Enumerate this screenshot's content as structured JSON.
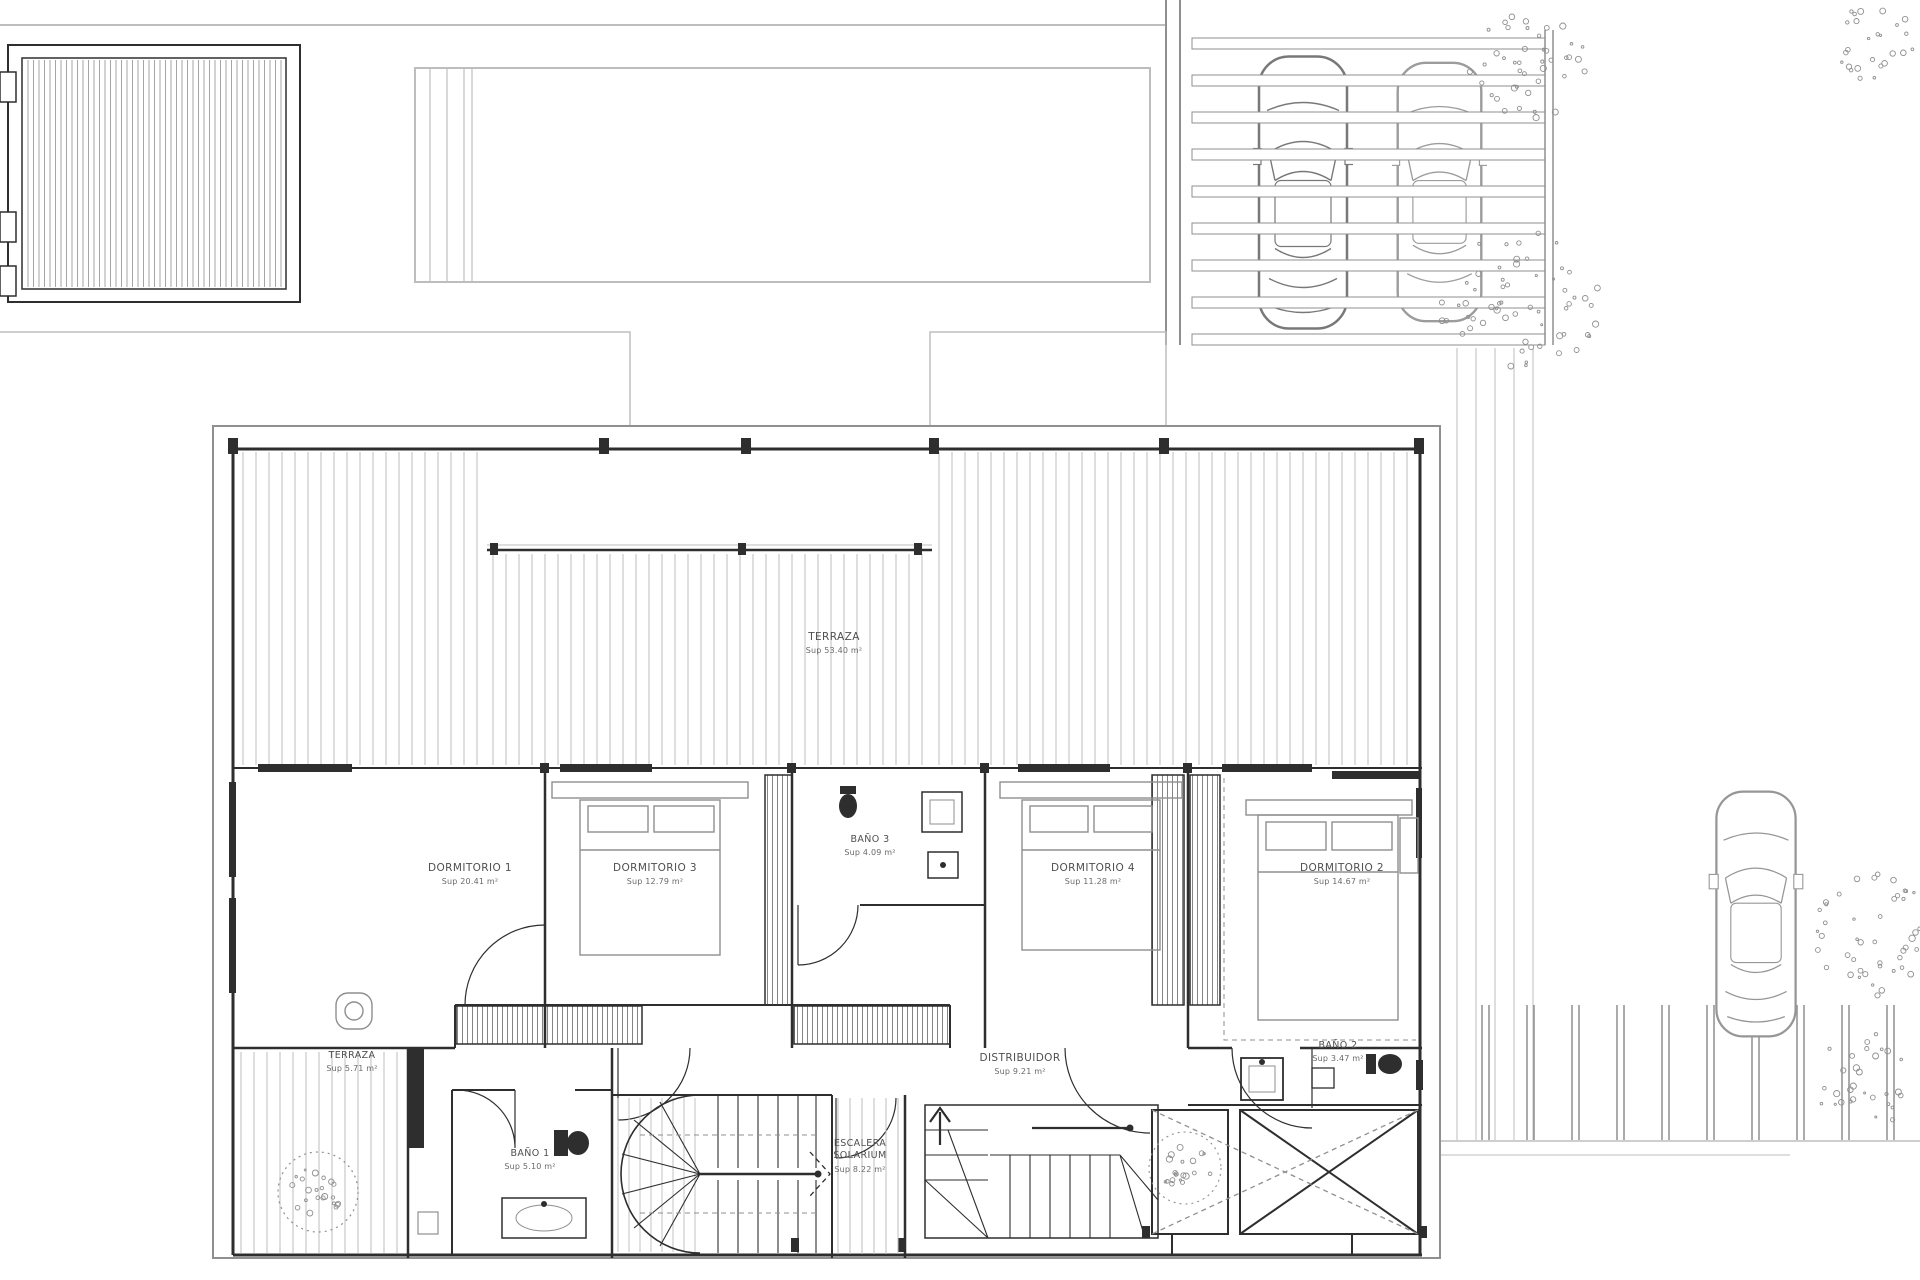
{
  "rooms": {
    "terraza_upper": {
      "name": "TERRAZA",
      "area": "Sup 53.40 m²"
    },
    "dormitorio1": {
      "name": "DORMITORIO 1",
      "area": "Sup 20.41 m²"
    },
    "dormitorio3": {
      "name": "DORMITORIO 3",
      "area": "Sup 12.79 m²"
    },
    "bano3": {
      "name": "BAÑO 3",
      "area": "Sup 4.09 m²"
    },
    "dormitorio4": {
      "name": "DORMITORIO 4",
      "area": "Sup 11.28 m²"
    },
    "dormitorio2": {
      "name": "DORMITORIO 2",
      "area": "Sup 14.67 m²"
    },
    "distribuidor": {
      "name": "DISTRIBUIDOR",
      "area": "Sup 9.21 m²"
    },
    "bano2": {
      "name": "BAÑO 2",
      "area": "Sup 3.47 m²"
    },
    "bano1": {
      "name": "BAÑO 1",
      "area": "Sup 5.10 m²"
    },
    "terraza_lower": {
      "name": "TERRAZA",
      "area": "Sup 5.71 m²"
    },
    "escalera": {
      "name": "ESCALERA SOLARIUM",
      "area": "Sup 8.22 m²"
    }
  },
  "colors": {
    "background": "#ffffff",
    "wall_dark": "#2e2e2e",
    "line_mid": "#8f8f8f",
    "line_light": "#bdbdbd",
    "label_text": "#4f4f4f",
    "area_text": "#6a6a6a"
  }
}
